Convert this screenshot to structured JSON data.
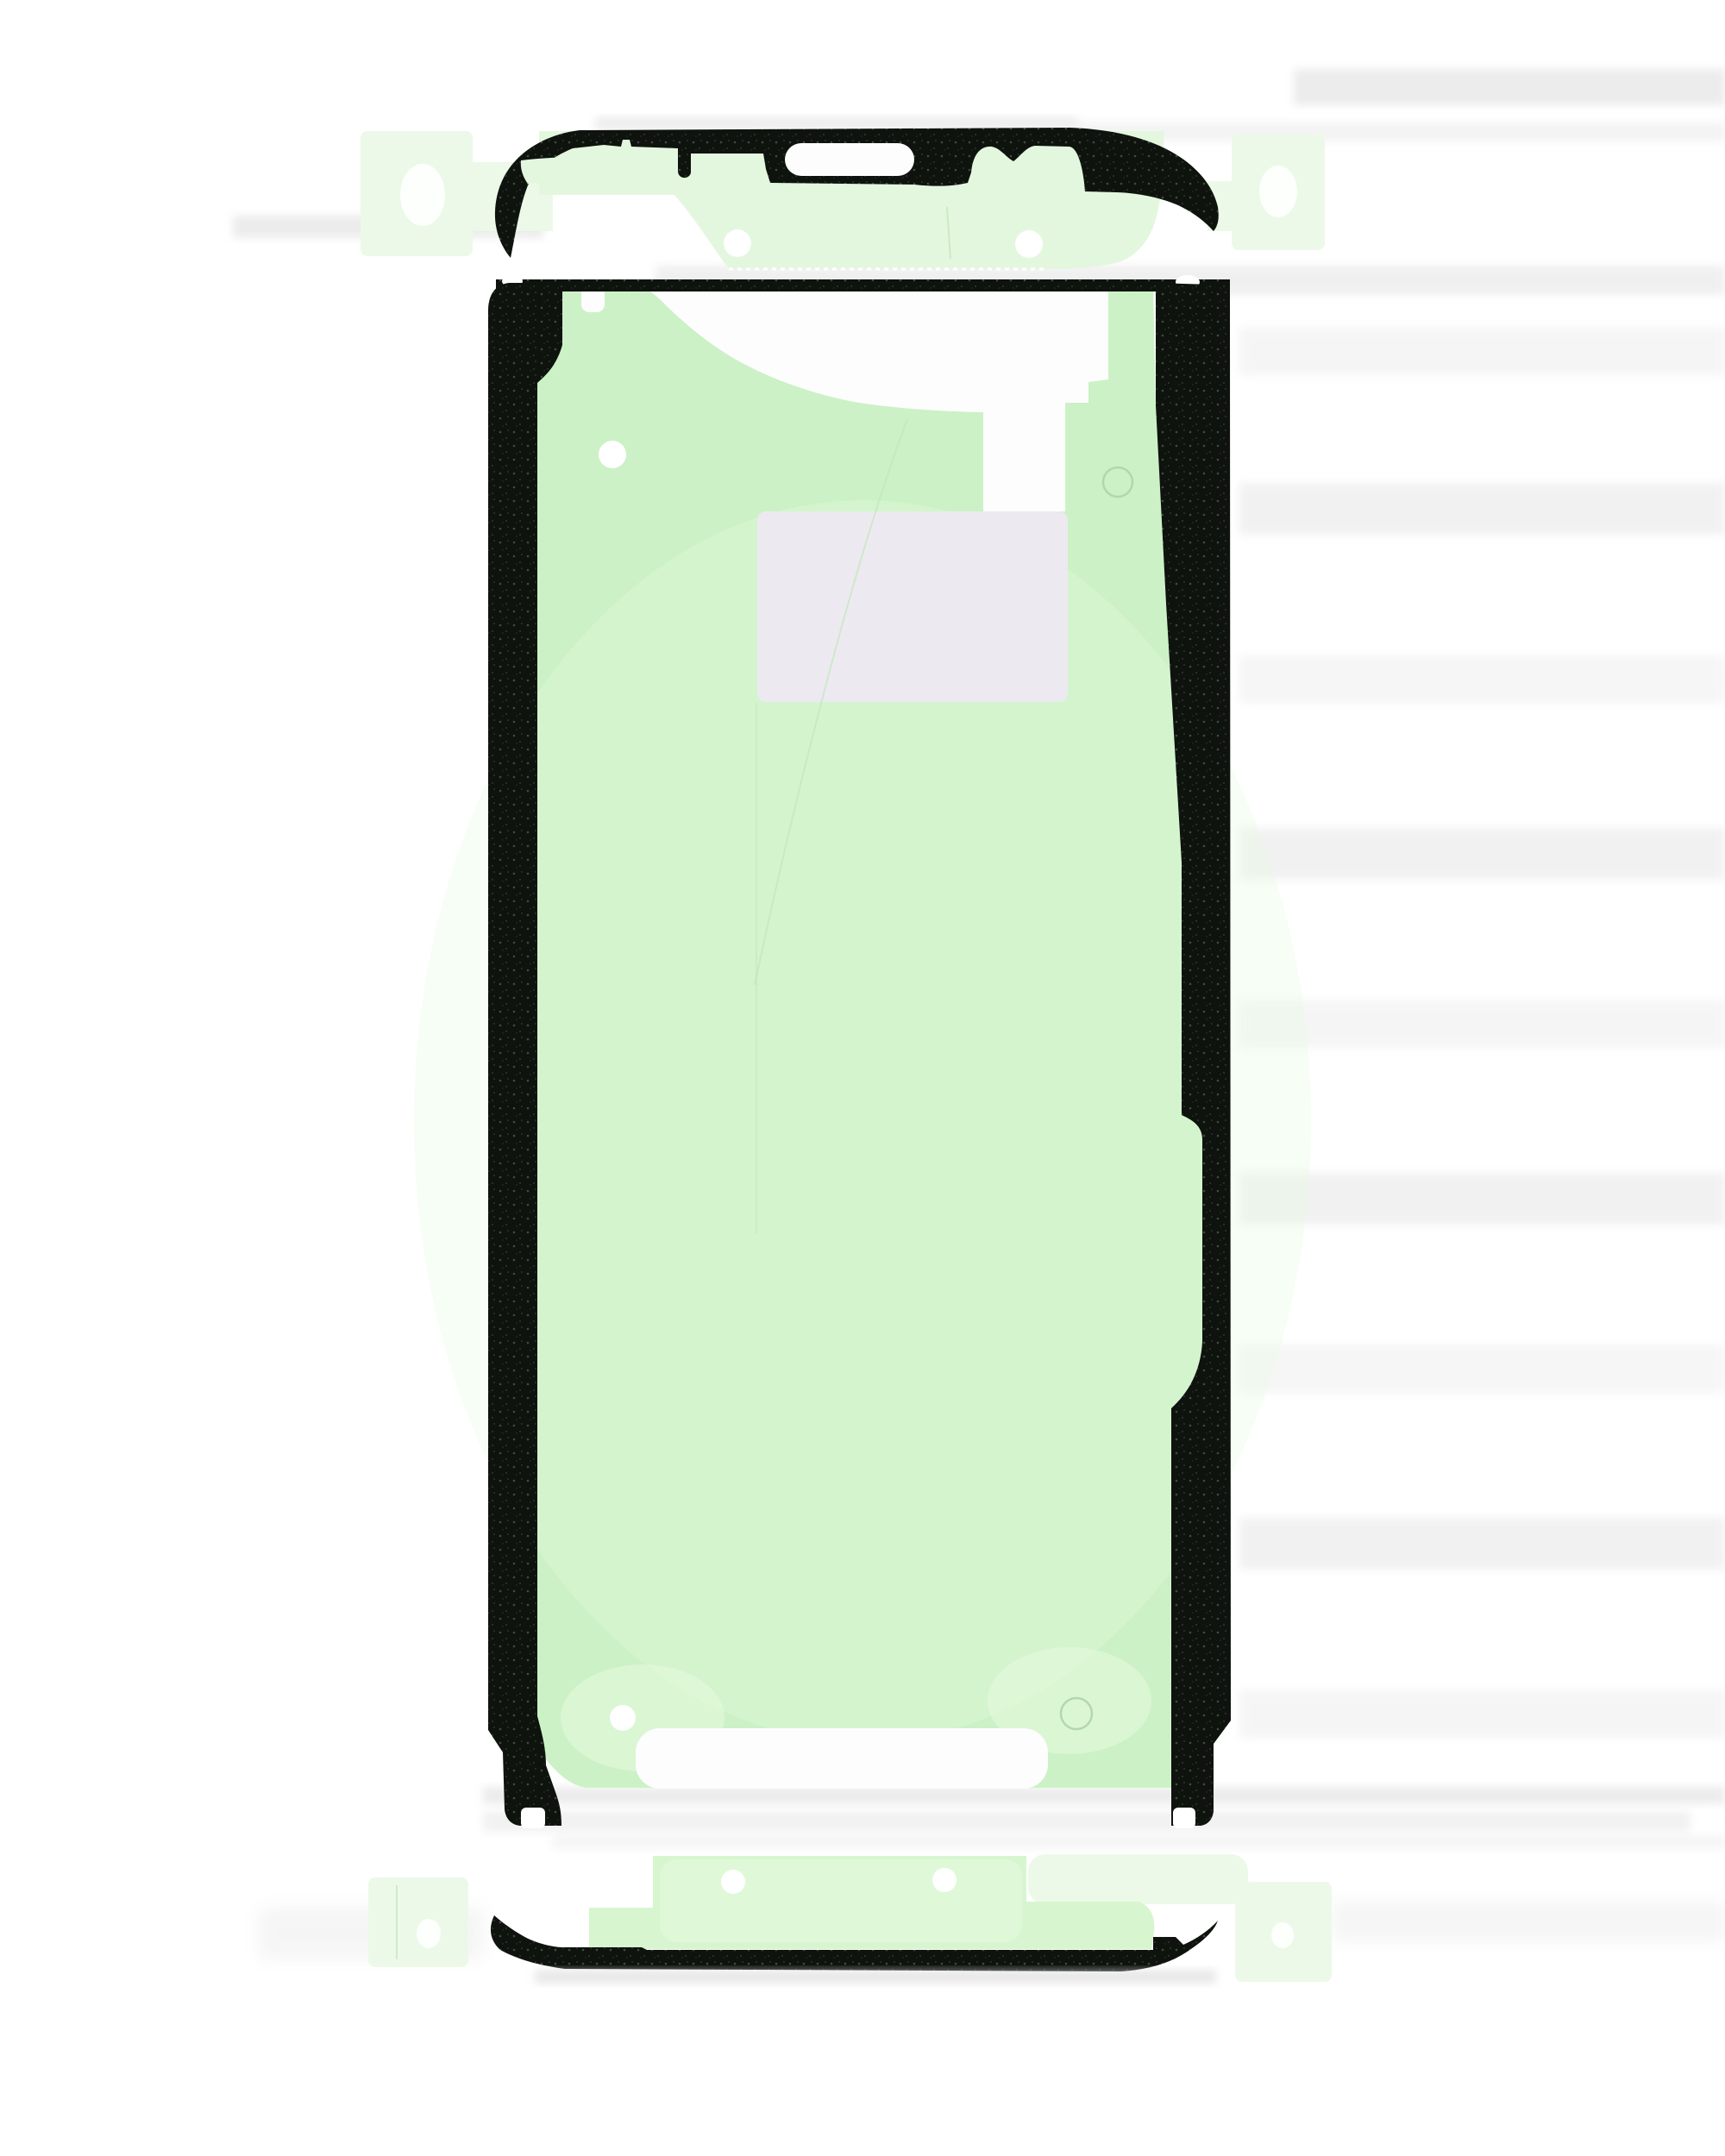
{
  "scene": {
    "kind": "product-photo",
    "parts": {
      "top_strip": "top-frame-adhesive-strip",
      "main_frame": "main-display-adhesive-frame",
      "bottom_strip": "bottom-frame-adhesive-strip"
    }
  },
  "colors": {
    "background": "#ffffff",
    "band": "#dcdcdc",
    "band_light": "#ececec",
    "shadow_gray": "#d9d9d9",
    "backing_green": "#ccf1c6",
    "backing_green_hi": "#e7fbe0",
    "strip_green": "#d7f6d0",
    "tongue_green": "#e3f7de",
    "tab_green": "#ecf9e8",
    "oval_white": "#fcfffb",
    "adhesive_black": "#0e130e",
    "speckle_a": "#404b3f",
    "speckle_b": "#2e382d",
    "cutout_white": "#fdfdfe",
    "liner_gray": "#eceaf0",
    "hole_white": "#fefffe",
    "emboss_stroke": "#abd2a5",
    "crease_stroke": "#c3e6bd",
    "slot_white": "#fdfdfd",
    "serration_stroke": "#ffffff"
  }
}
